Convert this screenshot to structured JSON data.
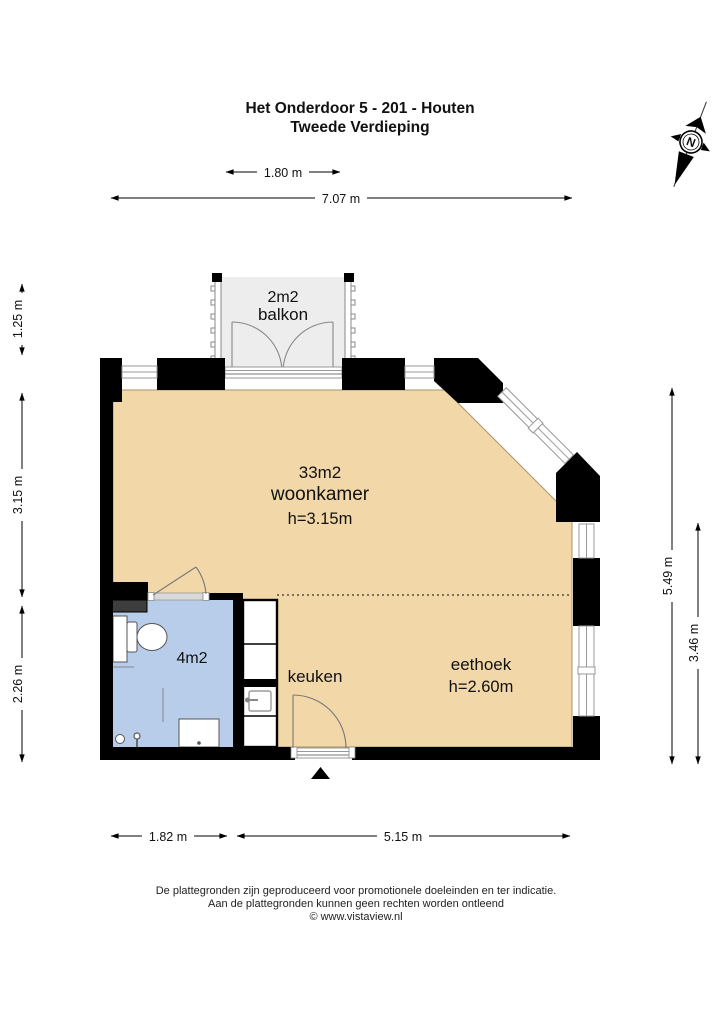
{
  "header": {
    "title_line1": "Het Onderdoor 5 - 201 - Houten",
    "title_line2": "Tweede Verdieping"
  },
  "compass": {
    "label": "N"
  },
  "dimensions": {
    "top_small": "1.80 m",
    "top_large": "7.07 m",
    "left_top": "1.25 m",
    "left_middle": "3.15 m",
    "left_bottom": "2.26 m",
    "right_outer": "5.49 m",
    "right_inner": "3.46 m",
    "bottom_left": "1.82 m",
    "bottom_right": "5.15 m"
  },
  "rooms": {
    "balkon": {
      "area": "2m2",
      "name": "balkon"
    },
    "woonkamer": {
      "area": "33m2",
      "name": "woonkamer",
      "ceiling": "h=3.15m"
    },
    "eethoek": {
      "name": "eethoek",
      "ceiling": "h=2.60m"
    },
    "keuken": {
      "name": "keuken"
    },
    "badkamer": {
      "area": "4m2"
    }
  },
  "footer": {
    "line1": "De plattegronden zijn geproduceerd voor promotionele doeleinden en ter indicatie.",
    "line2": "Aan de plattegronden kunnen geen rechten worden ontleend",
    "line3": "© www.vistaview.nl"
  },
  "colors": {
    "floor": "#f2d8a8",
    "bathroom": "#b7cde9",
    "balcony": "#ededed",
    "wall": "#000000",
    "shaft": "#3d3d3d"
  }
}
